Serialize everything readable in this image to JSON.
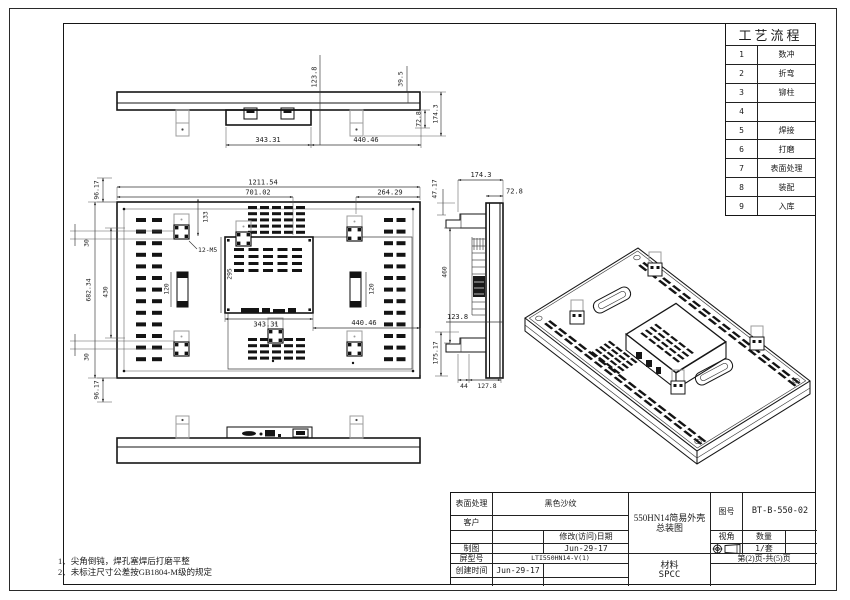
{
  "process_table": {
    "title": "工艺流程",
    "rows": [
      {
        "no": "1",
        "name": "数冲"
      },
      {
        "no": "2",
        "name": "折弯"
      },
      {
        "no": "3",
        "name": "铆柱"
      },
      {
        "no": "4",
        "name": ""
      },
      {
        "no": "5",
        "name": "焊接"
      },
      {
        "no": "6",
        "name": "打磨"
      },
      {
        "no": "7",
        "name": "表面处理"
      },
      {
        "no": "8",
        "name": "装配"
      },
      {
        "no": "9",
        "name": "入库"
      }
    ]
  },
  "title_block": {
    "surface_label": "表面处理",
    "surface_value": "黑色沙纹",
    "customer_label": "客户",
    "customer_value": "",
    "modify_date_label": "修改(访问)日期",
    "draft_label": "制图",
    "draft_date": "Jun-29-17",
    "model_label": "屏型号",
    "model_value": "LTI550HN14-V(1)",
    "create_label": "创建时间",
    "create_date": "Jun-29-17",
    "title_line1": "550HN14简易外壳",
    "title_line2": "总装图",
    "drawing_no_label": "图号",
    "drawing_no_value": "BT-B-550-02",
    "view_angle_label": "视角",
    "qty_label": "数量",
    "qty_value": "1/套",
    "page_info": "第(2)页-共(5)页",
    "material_label": "材料",
    "material_value": "SPCC"
  },
  "notes": [
    "1、尖角倒钝，焊孔塞焊后打磨平整",
    "2、未标注尺寸公差按GB1804-M级的规定"
  ],
  "dims": {
    "tv_123_8": "123.8",
    "tv_39_5": "39.5",
    "tv_72_8": "72.8",
    "tv_174_3": "174.3",
    "tv_343_31": "343.31",
    "tv_440_46": "440.46",
    "bv_96_17_t": "96.17",
    "bv_1211_54": "1211.54",
    "bv_701_02": "701.02",
    "bv_264_29": "264.29",
    "bv_30_t": "30",
    "bv_133": "133",
    "bv_12_m5": "12-M5",
    "bv_682_34": "682.34",
    "bv_430": "430",
    "bv_295": "295",
    "bv_120_l": "120",
    "bv_120_r": "120",
    "bv_343_31": "343.31",
    "bv_440_46": "440.46",
    "bv_30_b": "30",
    "bv_96_17_b": "96.17",
    "sv_174_3": "174.3",
    "sv_72_8": "72.8",
    "sv_47_17": "47.17",
    "sv_460": "460",
    "sv_123_8": "123.8",
    "sv_175_17": "175.17",
    "sv_44": "44",
    "sv_127_8": "127.8"
  }
}
